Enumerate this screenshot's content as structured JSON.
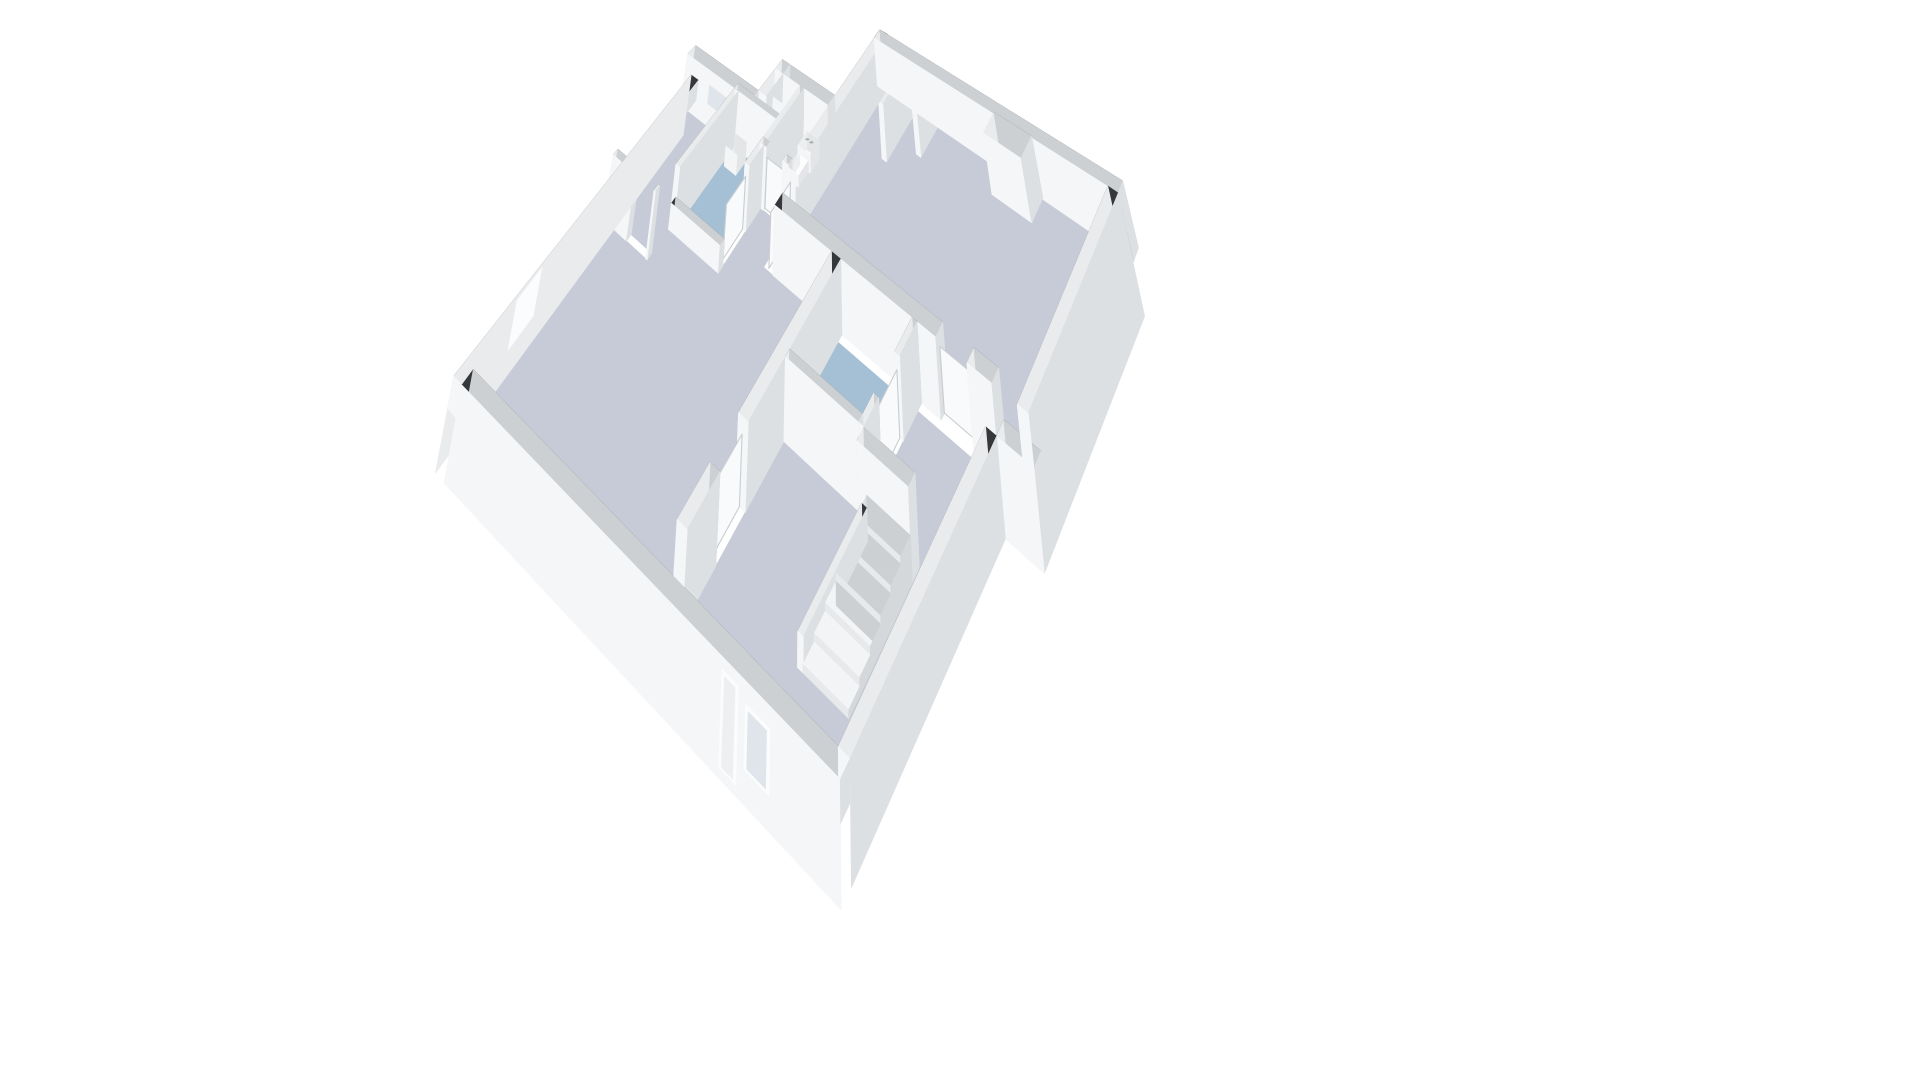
{
  "meta": {
    "title": "3D floor plan — isometric dollhouse view of an apartment storey",
    "description": "White-walled 3D cutaway floor plan on a white background. Dark wall tops, white wall faces, grey-lavender room floors, blue bathroom floors, a toilet fixture, a wash basin, a wardrobe, an interior staircase, and window / door openings in the outer walls."
  },
  "rooms": [
    {
      "id": "living-room",
      "floor": "main",
      "features": [
        "chimney-nub",
        "entry-partitions"
      ]
    },
    {
      "id": "bedroom-northwest",
      "floor": "main",
      "features": [
        "window-north-wall"
      ]
    },
    {
      "id": "closet",
      "floor": "main",
      "features": [
        "wardrobe"
      ]
    },
    {
      "id": "toilet-room",
      "floor": "blue-light",
      "features": [
        "toilet"
      ]
    },
    {
      "id": "bathroom-west",
      "floor": "blue",
      "features": [
        "wash-basin"
      ]
    },
    {
      "id": "bathroom-east",
      "floor": "blue",
      "features": [
        "door-east-wall"
      ]
    },
    {
      "id": "main-room-south",
      "floor": "main",
      "features": [
        "windows-south-wall",
        "windows-west-wall"
      ]
    },
    {
      "id": "entry-hall",
      "floor": "main",
      "features": [
        "staircase",
        "front-door"
      ]
    }
  ],
  "colors": {
    "background": "#ffffff",
    "wall_top": "#35373a",
    "face_s": "#f5f6f7",
    "face_w": "#e9ebec",
    "face_e": "#dde0e2",
    "face_n": "#cdd0d3",
    "step_top": "#f3f4f5",
    "step_s": "#e7e9eb",
    "step_w": "#dee1e3",
    "step_e": "#d5d8da",
    "fix_top": "#fdfdfe",
    "fix_s": "#f4f5f6",
    "fix_w": "#eceeef",
    "fix_e": "#e3e5e7",
    "floor_main": "#c6cbd7",
    "floor_blue": "#a5c0d4",
    "floor_blue_light": "#bed0dd",
    "glass": "#dfe5ea",
    "frame": "#fbfcfd",
    "door_fill": "#edeff0",
    "leaf": "#f8fafb",
    "leaf_edge": "#c9cdd0",
    "button": "#a6abaf"
  },
  "scene": {
    "skirt_depth": 1.9,
    "wall_height_full": 2.6,
    "wall_height_cut": 1.0,
    "floors": [
      {
        "n": "floor-living",
        "c": "main",
        "poly": [
          [
            4.9,
            0.3
          ],
          [
            12.3,
            0.3
          ],
          [
            12.3,
            4.7
          ],
          [
            4.9,
            4.7
          ]
        ]
      },
      {
        "n": "floor-toilet",
        "c": "blueLight",
        "poly": [
          [
            3.7,
            2.5
          ],
          [
            4.6,
            2.5
          ],
          [
            4.6,
            4.0
          ],
          [
            3.7,
            4.0
          ]
        ]
      },
      {
        "n": "floor-closet",
        "c": "main",
        "poly": [
          [
            2.9,
            2.5
          ],
          [
            3.55,
            2.5
          ],
          [
            3.55,
            3.35
          ],
          [
            2.9,
            3.35
          ]
        ]
      },
      {
        "n": "floor-bedroom",
        "c": "main",
        "poly": [
          [
            0.3,
            3.5
          ],
          [
            1.95,
            3.5
          ],
          [
            1.95,
            6.2
          ],
          [
            0.3,
            6.2
          ]
        ]
      },
      {
        "n": "floor-bath-west",
        "c": "blue",
        "poly": [
          [
            2.1,
            3.5
          ],
          [
            3.55,
            3.5
          ],
          [
            3.55,
            5.5
          ],
          [
            2.1,
            5.5
          ]
        ]
      },
      {
        "n": "floor-bath-east",
        "c": "blue",
        "poly": [
          [
            7.1,
            5.15
          ],
          [
            9.3,
            5.15
          ],
          [
            9.3,
            6.9
          ],
          [
            7.1,
            6.9
          ]
        ]
      },
      {
        "n": "floor-main-south",
        "c": "main",
        "poly": [
          [
            0.3,
            6.35
          ],
          [
            1.95,
            6.35
          ],
          [
            1.95,
            5.65
          ],
          [
            3.7,
            5.65
          ],
          [
            3.7,
            4.15
          ],
          [
            4.6,
            4.15
          ],
          [
            4.6,
            5.0
          ],
          [
            6.8,
            5.0
          ],
          [
            6.8,
            10.2
          ],
          [
            0.3,
            10.2
          ]
        ]
      },
      {
        "n": "floor-entry",
        "c": "main",
        "poly": [
          [
            9.45,
            5.15
          ],
          [
            11.3,
            5.15
          ],
          [
            11.3,
            10.2
          ],
          [
            7.1,
            10.2
          ],
          [
            7.1,
            7.05
          ],
          [
            9.45,
            7.05
          ]
        ]
      }
    ],
    "walls": [
      {
        "n": "wall-living-north",
        "x": [
          4.6,
          12.6
        ],
        "y": [
          0,
          0.3
        ],
        "h": 2.6
      },
      {
        "n": "wall-living-east",
        "x": [
          12.3,
          12.6
        ],
        "y": [
          0.3,
          5.0
        ],
        "h": 2.6,
        "sk": "E"
      },
      {
        "n": "wall-living-west",
        "x": [
          4.6,
          4.9
        ],
        "y": [
          0,
          4.2
        ],
        "h": 2.6
      },
      {
        "n": "wall-living-south-a",
        "x": [
          4.9,
          10.0
        ],
        "y": [
          4.7,
          5.0
        ],
        "h": 2.6
      },
      {
        "n": "wall-living-south-b",
        "x": [
          10.9,
          11.6
        ],
        "y": [
          4.7,
          5.0
        ],
        "h": 2.6
      },
      {
        "n": "wall-living-south-ext",
        "x": [
          11.6,
          12.6
        ],
        "y": [
          4.7,
          5.0
        ],
        "h": 1.0,
        "sk": "S"
      },
      {
        "n": "wall-southblock-east",
        "x": [
          11.3,
          11.6
        ],
        "y": [
          5.0,
          10.2
        ],
        "h": 1.0,
        "sk": "E"
      },
      {
        "n": "wall-south",
        "x": [
          0.3,
          11.6
        ],
        "y": [
          10.2,
          10.5
        ],
        "h": 1.0,
        "sk": "S"
      },
      {
        "n": "wall-west",
        "x": [
          0,
          0.3
        ],
        "y": [
          3.2,
          10.5
        ],
        "h": 1.0,
        "sk": "W"
      },
      {
        "n": "wall-wing-north",
        "x": [
          0,
          2.6
        ],
        "y": [
          3.2,
          3.5
        ],
        "h": 2.6
      },
      {
        "n": "wall-notch-west",
        "x": [
          2.6,
          2.9
        ],
        "y": [
          2.2,
          3.2
        ],
        "h": 2.6
      },
      {
        "n": "wall-toiletblock-north",
        "x": [
          2.6,
          4.6
        ],
        "y": [
          2.2,
          2.5
        ],
        "h": 2.6
      },
      {
        "n": "wall-toilet-west",
        "x": [
          3.55,
          3.7
        ],
        "y": [
          2.5,
          4.0
        ],
        "h": 2.6
      },
      {
        "n": "wall-toilet-south-a",
        "x": [
          3.55,
          3.8
        ],
        "y": [
          4.0,
          4.15
        ],
        "h": 2.6
      },
      {
        "n": "wall-toilet-south-b",
        "x": [
          4.4,
          4.6
        ],
        "y": [
          4.0,
          4.15
        ],
        "h": 2.6
      },
      {
        "n": "wall-bath-north",
        "x": [
          1.95,
          3.7
        ],
        "y": [
          3.35,
          3.5
        ],
        "h": 2.6
      },
      {
        "n": "wall-closet-west",
        "x": [
          2.75,
          2.9
        ],
        "y": [
          2.5,
          3.35
        ],
        "h": 2.6
      },
      {
        "n": "wall-bath-west",
        "x": [
          1.95,
          2.1
        ],
        "y": [
          3.5,
          5.65
        ],
        "h": 2.6
      },
      {
        "n": "wall-bath-east",
        "x": [
          3.55,
          3.7
        ],
        "y": [
          4.15,
          4.7
        ],
        "h": 2.6
      },
      {
        "n": "wall-bath-south-low",
        "x": [
          1.95,
          3.7
        ],
        "y": [
          5.5,
          5.65
        ],
        "h": 1.0
      },
      {
        "n": "wall-bedroom-south-a",
        "x": [
          0.3,
          1.2
        ],
        "y": [
          6.2,
          6.35
        ],
        "h": 2.6
      },
      {
        "n": "wall-bedroom-south-b",
        "x": [
          1.9,
          1.95
        ],
        "y": [
          6.2,
          6.35
        ],
        "h": 2.6
      },
      {
        "n": "wall-southblock-west-a",
        "x": [
          6.8,
          7.1
        ],
        "y": [
          5.0,
          8.3
        ],
        "h": 2.6
      },
      {
        "n": "wall-southblock-west-b",
        "x": [
          6.8,
          7.1
        ],
        "y": [
          9.2,
          10.2
        ],
        "h": 2.6
      },
      {
        "n": "wall-bath-east-east-a",
        "x": [
          9.3,
          9.45
        ],
        "y": [
          5.0,
          5.7
        ],
        "h": 2.6
      },
      {
        "n": "wall-bath-east-east-b",
        "x": [
          9.3,
          9.45
        ],
        "y": [
          6.5,
          7.05
        ],
        "h": 2.6
      },
      {
        "n": "wall-bath-east-south",
        "x": [
          7.1,
          9.3
        ],
        "y": [
          6.9,
          7.05
        ],
        "h": 2.6
      },
      {
        "n": "wall-stair-north",
        "x": [
          9.45,
          10.9
        ],
        "y": [
          7.05,
          7.3
        ],
        "h": 2.6
      },
      {
        "n": "wall-stair-stringer",
        "x": [
          9.55,
          9.7
        ],
        "y": [
          7.3,
          9.4
        ],
        "h": 0.9
      },
      {
        "n": "wall-chimney-nub",
        "x": [
          8.8,
          10.0
        ],
        "y": [
          0.3,
          0.9
        ],
        "h": 2.6
      },
      {
        "n": "wall-entry-stub-a",
        "x": [
          5.8,
          5.95
        ],
        "y": [
          0.3,
          1.7
        ],
        "h": 2.6
      },
      {
        "n": "wall-entry-stub-b",
        "x": [
          6.55,
          6.7
        ],
        "y": [
          0.3,
          1.15
        ],
        "h": 2.6
      }
    ],
    "steps": {
      "x": [
        9.7,
        10.9
      ],
      "y0": 7.3,
      "depth": 0.35,
      "heights": [
        1.26,
        1.05,
        0.84,
        0.63,
        0.42,
        0.21
      ]
    },
    "fixtures": [
      {
        "n": "wardrobe",
        "x": [
          2.95,
          3.5
        ],
        "y": [
          2.55,
          2.95
        ],
        "z": [
          0,
          2.2
        ]
      },
      {
        "n": "toilet-tank",
        "x": [
          3.88,
          4.32
        ],
        "y": [
          2.55,
          2.92
        ],
        "z": [
          0,
          0.78
        ]
      },
      {
        "n": "toilet-bowl",
        "x": [
          3.95,
          4.25
        ],
        "y": [
          2.92,
          3.32
        ],
        "z": [
          0,
          0.44
        ]
      },
      {
        "n": "wash-basin",
        "x": [
          2.2,
          2.62
        ],
        "y": [
          3.6,
          3.95
        ],
        "z": [
          0,
          0.85
        ]
      }
    ],
    "dots": [
      {
        "n": "flush-button-left",
        "p": [
          4.02,
          2.7,
          0.82
        ],
        "r": 3.2
      },
      {
        "n": "flush-button-right",
        "p": [
          4.17,
          2.7,
          0.82
        ],
        "r": 3.2
      }
    ],
    "decals": [
      {
        "n": "window-south-1",
        "type": "window",
        "plane": "S",
        "at": 10.5,
        "u": [
          2.7,
          3.3
        ],
        "z": [
          -1.5,
          0.75
        ]
      },
      {
        "n": "window-south-2",
        "type": "window",
        "plane": "S",
        "at": 10.5,
        "u": [
          3.8,
          4.4
        ],
        "z": [
          -1.5,
          0.75
        ]
      },
      {
        "n": "window-south-3",
        "type": "window",
        "plane": "S",
        "at": 10.5,
        "u": [
          5.9,
          6.6
        ],
        "z": [
          -1.0,
          0.55
        ]
      },
      {
        "n": "front-door",
        "type": "doorglass",
        "plane": "S",
        "at": 10.5,
        "u": [
          8.5,
          8.95
        ],
        "z": [
          -1.55,
          0.8
        ]
      },
      {
        "n": "window-south-4",
        "type": "window",
        "plane": "S",
        "at": 10.5,
        "u": [
          9.15,
          9.8
        ],
        "z": [
          -1.0,
          0.55
        ]
      },
      {
        "n": "window-west-1",
        "type": "window",
        "plane": "W",
        "at": 0.0,
        "u": [
          6.5,
          7.2
        ],
        "z": [
          -1.0,
          0.55
        ]
      },
      {
        "n": "window-west-2",
        "type": "window",
        "plane": "W",
        "at": 0.0,
        "u": [
          8.0,
          8.7
        ],
        "z": [
          -1.1,
          0.55
        ]
      },
      {
        "n": "window-bedroom-north",
        "type": "window",
        "plane": "S",
        "at": 3.5,
        "u": [
          0.95,
          1.85
        ],
        "z": [
          0.95,
          2.05
        ]
      },
      {
        "n": "door-leaf-toilet",
        "type": "leaf",
        "plane": "S",
        "at": 4.075,
        "u": [
          3.8,
          4.4
        ],
        "z": [
          0,
          2.08
        ]
      },
      {
        "n": "door-leaf-living-west",
        "type": "leaf",
        "plane": "W",
        "at": 4.75,
        "u": [
          4.2,
          4.95
        ],
        "z": [
          0,
          2.08
        ]
      },
      {
        "n": "door-leaf-living-south",
        "type": "leaf",
        "plane": "S",
        "at": 4.85,
        "u": [
          10.0,
          10.9
        ],
        "z": [
          0,
          2.08
        ]
      },
      {
        "n": "door-leaf-hall-east",
        "type": "leaf",
        "plane": "W",
        "at": 6.95,
        "u": [
          8.3,
          9.2
        ],
        "z": [
          0,
          2.08
        ]
      },
      {
        "n": "door-leaf-bath-east",
        "type": "leaf",
        "plane": "W",
        "at": 9.37,
        "u": [
          5.7,
          6.5
        ],
        "z": [
          0,
          2.08
        ]
      },
      {
        "n": "door-leaf-bath-west",
        "type": "leaf",
        "plane": "W",
        "at": 3.62,
        "u": [
          4.7,
          5.4
        ],
        "z": [
          0,
          2.08
        ]
      }
    ]
  }
}
